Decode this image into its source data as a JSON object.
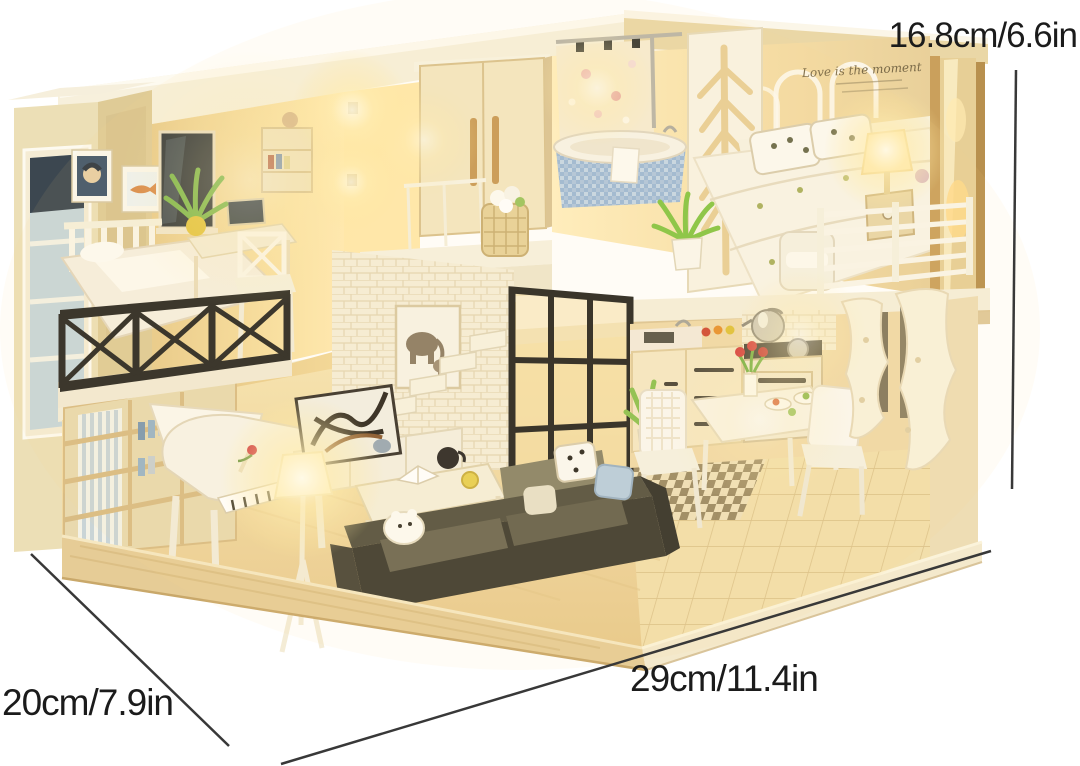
{
  "annotations": {
    "height": {
      "label": "16.8cm/6.6in"
    },
    "depth": {
      "label": "20cm/7.9in"
    },
    "width": {
      "label": "29cm/11.4in"
    }
  },
  "dollhouse": {
    "wall_quote": "Love is the moment"
  },
  "colors": {
    "background": "#ffffff",
    "annotation_text": "#1b1b1b",
    "dimension_line": "#383838",
    "warm_glow": "#ffeaa6",
    "cream_wall": "#eedcab",
    "wood_base": "#e3c68e",
    "dark_railing": "#2c2a24",
    "sofa_charcoal": "#403d31",
    "bathtub_mosaic_blue": "#a4bfda",
    "plant_green": "#8cc04e",
    "tulip_red": "#d63c3c"
  }
}
